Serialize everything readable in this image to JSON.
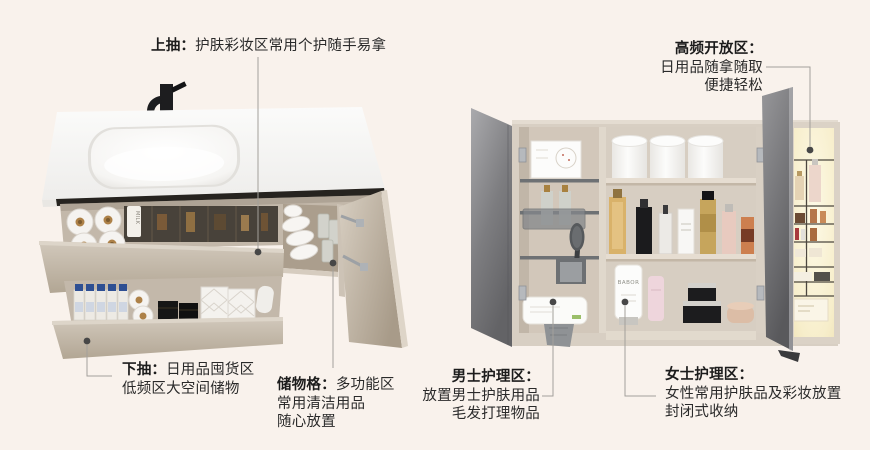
{
  "page": {
    "background": "#f9f2ec"
  },
  "palette": {
    "text": "#2a2a2a",
    "connector_line": "#a3a09b",
    "connector_dot": "#474747",
    "cabinet_greige": "#c9bfb2",
    "mirror_door_gray": "#88888b",
    "countertop_white": "#f7f6f4",
    "niche_glow": "#f8efcf",
    "faucet_black": "#1d1d1f"
  },
  "callouts": {
    "top_drawer": {
      "label": "上抽：",
      "desc": "护肤彩妆区常用个护随手易拿"
    },
    "high_freq_open_zone": {
      "label": "高频开放区：",
      "lines": [
        "日用品随拿随取",
        "便捷轻松"
      ]
    },
    "bottom_drawer": {
      "label": "下抽：",
      "desc": "日用品囤货区",
      "lines": [
        "低频区大空间储物"
      ]
    },
    "storage_grid": {
      "label": "储物格：",
      "desc": "多功能区",
      "lines": [
        "常用清洁用品",
        "随心放置"
      ]
    },
    "mens_care_zone": {
      "label": "男士护理区：",
      "lines": [
        "放置男士护肤用品",
        "毛发打理物品"
      ]
    },
    "womens_care_zone": {
      "label": "女士护理区：",
      "lines": [
        "女性常用护肤品及彩妆放置",
        "封闭式收纳"
      ]
    }
  },
  "product_labels": {
    "tube_brand": "BABOR",
    "milk_bottle": "MILK"
  }
}
